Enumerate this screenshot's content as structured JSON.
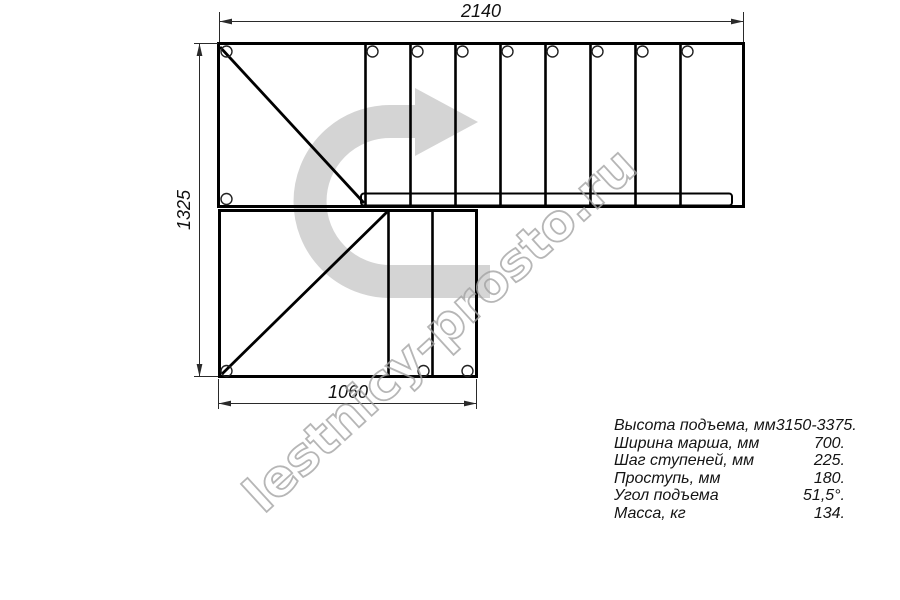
{
  "drawing": {
    "watermark": "lestnicy-prosto.ru",
    "dimensions": {
      "top_width": "2140",
      "left_height": "1325",
      "bottom_width": "1060"
    }
  },
  "specs": {
    "rows": [
      {
        "label": "Высота подъема, мм",
        "value": "3150-3375."
      },
      {
        "label": "Ширина марша, мм",
        "value": "700."
      },
      {
        "label": "Шаг ступеней, мм",
        "value": "225."
      },
      {
        "label": "Проступь, мм",
        "value": "180."
      },
      {
        "label": "Угол подъема",
        "value": "51,5°."
      },
      {
        "label": "Масса, кг",
        "value": "134."
      }
    ]
  },
  "colors": {
    "line": "#000000",
    "dimension": "#2a2a2a",
    "arrow_fill": "#d4d4d4",
    "watermark_gray": "#a4a4a4"
  }
}
